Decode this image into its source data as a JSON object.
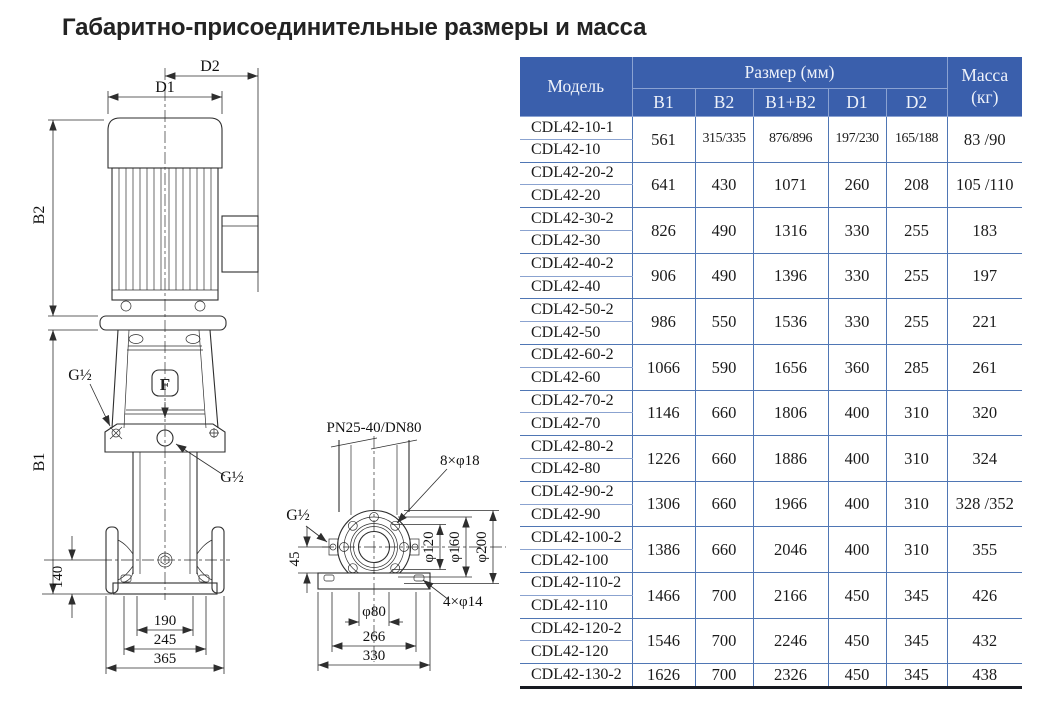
{
  "title": "Габаритно-присоединительные размеры и масса",
  "drawing": {
    "front": {
      "d2": "D2",
      "d1": "D1",
      "b2": "B2",
      "b1": "B1",
      "g_port_left": "G½",
      "g_port_center": "G½",
      "logo": "F",
      "dim140": "140",
      "dim190": "190",
      "dim245": "245",
      "dim365": "365"
    },
    "flange": {
      "pn": "PN25-40/DN80",
      "bolts8": "8×φ18",
      "g_port": "G½",
      "dim45": "45",
      "d120": "φ120",
      "d160": "φ160",
      "d200": "φ200",
      "d80": "φ80",
      "dim266": "266",
      "dim330": "330",
      "bolts4": "4×φ14"
    }
  },
  "table": {
    "header": {
      "model": "Модель",
      "size_group": "Размер (мм)",
      "size_cols": [
        "B1",
        "B2",
        "B1+B2",
        "D1",
        "D2"
      ],
      "mass_label": "Масса",
      "mass_unit": "(кг)"
    },
    "groups": [
      {
        "models": [
          "CDL42-10-1",
          "CDL42-10"
        ],
        "b1": "561",
        "b2": "315/335",
        "b1b2": "876/896",
        "d1": "197/230",
        "d2": "165/188",
        "mass": "83 /90"
      },
      {
        "models": [
          "CDL42-20-2",
          "CDL42-20"
        ],
        "b1": "641",
        "b2": "430",
        "b1b2": "1071",
        "d1": "260",
        "d2": "208",
        "mass": "105 /110"
      },
      {
        "models": [
          "CDL42-30-2",
          "CDL42-30"
        ],
        "b1": "826",
        "b2": "490",
        "b1b2": "1316",
        "d1": "330",
        "d2": "255",
        "mass": "183"
      },
      {
        "models": [
          "CDL42-40-2",
          "CDL42-40"
        ],
        "b1": "906",
        "b2": "490",
        "b1b2": "1396",
        "d1": "330",
        "d2": "255",
        "mass": "197"
      },
      {
        "models": [
          "CDL42-50-2",
          "CDL42-50"
        ],
        "b1": "986",
        "b2": "550",
        "b1b2": "1536",
        "d1": "330",
        "d2": "255",
        "mass": "221"
      },
      {
        "models": [
          "CDL42-60-2",
          "CDL42-60"
        ],
        "b1": "1066",
        "b2": "590",
        "b1b2": "1656",
        "d1": "360",
        "d2": "285",
        "mass": "261"
      },
      {
        "models": [
          "CDL42-70-2",
          "CDL42-70"
        ],
        "b1": "1146",
        "b2": "660",
        "b1b2": "1806",
        "d1": "400",
        "d2": "310",
        "mass": "320"
      },
      {
        "models": [
          "CDL42-80-2",
          "CDL42-80"
        ],
        "b1": "1226",
        "b2": "660",
        "b1b2": "1886",
        "d1": "400",
        "d2": "310",
        "mass": "324"
      },
      {
        "models": [
          "CDL42-90-2",
          "CDL42-90"
        ],
        "b1": "1306",
        "b2": "660",
        "b1b2": "1966",
        "d1": "400",
        "d2": "310",
        "mass": "328 /352"
      },
      {
        "models": [
          "CDL42-100-2",
          "CDL42-100"
        ],
        "b1": "1386",
        "b2": "660",
        "b1b2": "2046",
        "d1": "400",
        "d2": "310",
        "mass": "355"
      },
      {
        "models": [
          "CDL42-110-2",
          "CDL42-110"
        ],
        "b1": "1466",
        "b2": "700",
        "b1b2": "2166",
        "d1": "450",
        "d2": "345",
        "mass": "426"
      },
      {
        "models": [
          "CDL42-120-2",
          "CDL42-120"
        ],
        "b1": "1546",
        "b2": "700",
        "b1b2": "2246",
        "d1": "450",
        "d2": "345",
        "mass": "432"
      },
      {
        "models": [
          "CDL42-130-2"
        ],
        "b1": "1626",
        "b2": "700",
        "b1b2": "2326",
        "d1": "450",
        "d2": "345",
        "mass": "438"
      }
    ],
    "colors": {
      "header_bg": "#3a5fac",
      "header_text": "#eef2fa",
      "grid": "#4f76b4",
      "body_text": "#1b1b1b",
      "bottom_border": "#171a21"
    }
  }
}
